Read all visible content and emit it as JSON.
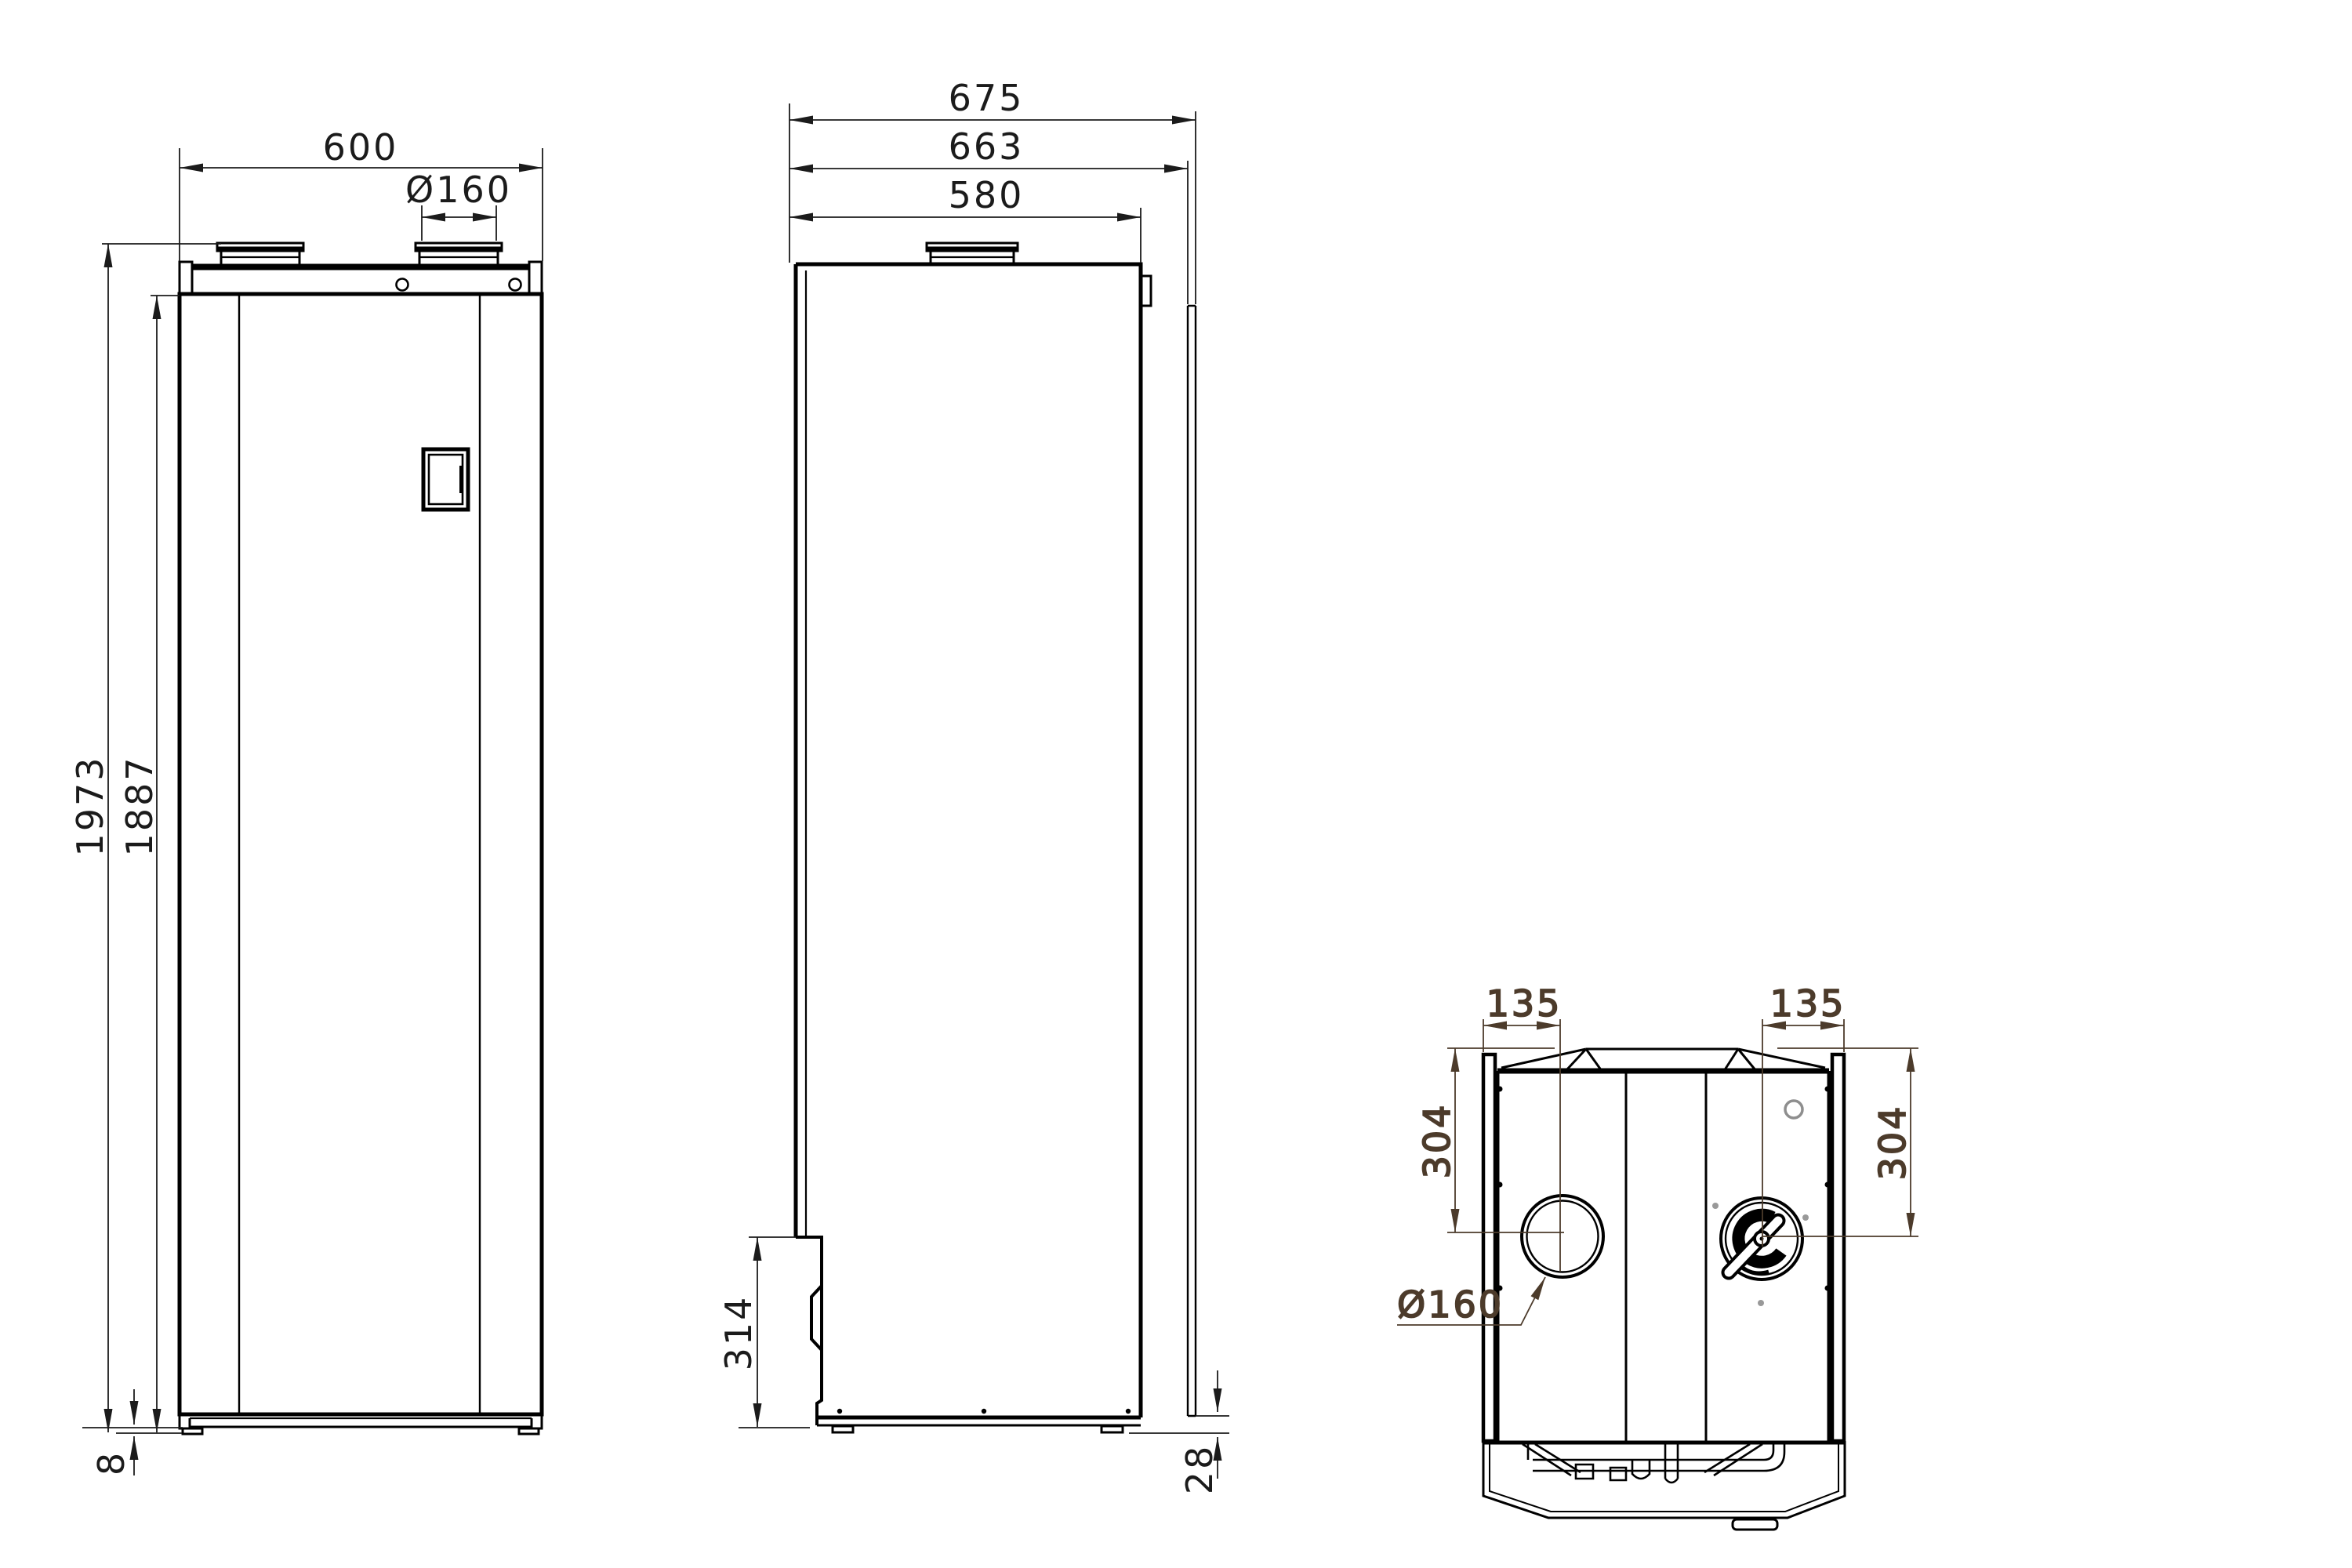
{
  "drawing": {
    "type": "dimensional line drawing, three orthographic views of a ventilation / heat-pump unit",
    "colors": {
      "line": "#000000",
      "dimension": "#1b1b1b",
      "top_view_dimension": "#4c3b2b",
      "detail_gray": "#8e8e8e",
      "background": "#ffffff"
    },
    "dims": {
      "front_width": "600",
      "front_duct": "Ø160",
      "front_height_total": "1973",
      "front_height_body": "1887",
      "front_foot_height": "8",
      "side_depth_total": "675",
      "side_depth_rear_panel": "663",
      "side_depth_body": "580",
      "side_recess_height": "314",
      "side_rear_clearance": "28",
      "top_offset_left": "135",
      "top_offset_right": "135",
      "top_center_depth_left": "304",
      "top_center_depth_right": "304",
      "top_duct_diameter": "Ø160"
    }
  }
}
